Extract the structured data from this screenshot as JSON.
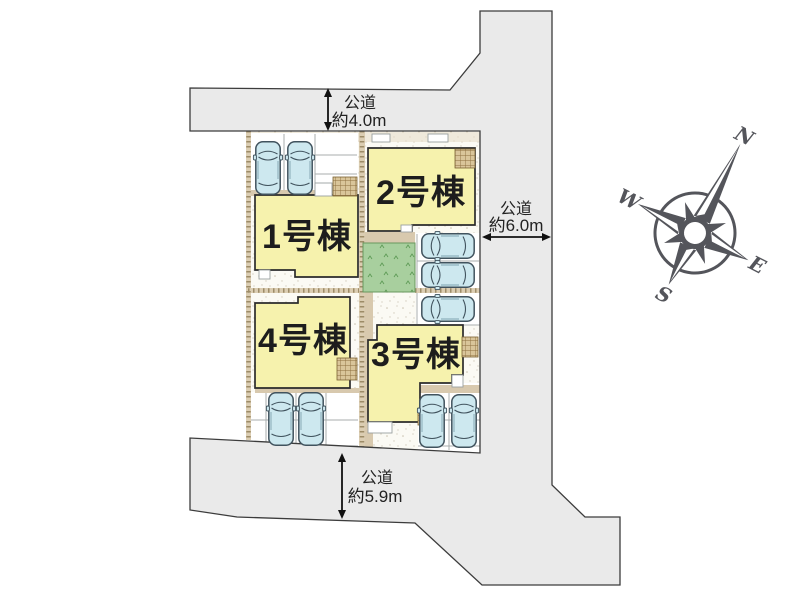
{
  "site_plan": {
    "buildings": [
      {
        "label": "1号棟"
      },
      {
        "label": "2号棟"
      },
      {
        "label": "3号棟"
      },
      {
        "label": "4号棟"
      }
    ],
    "roads": {
      "top": {
        "type_label": "公道",
        "width_label": "約4.0m"
      },
      "right": {
        "type_label": "公道",
        "width_label": "約6.0m"
      },
      "bottom": {
        "type_label": "公道",
        "width_label": "約5.9m"
      }
    },
    "compass": {
      "north": "N",
      "east": "E",
      "south": "S",
      "west": "W"
    }
  },
  "colors": {
    "background": "#ffffff",
    "road": "#eaeaea",
    "road_outline": "#3c3c3c",
    "building": "#f6f2ad",
    "building_outline": "#2b2b2b",
    "car": "#cde8ef",
    "car_outline": "#41535e",
    "garden": "#a8cf9e",
    "path_tan": "#d8c9ae",
    "porch_tan": "#d9c59a",
    "compass": "#54555b",
    "label_text": "#1d1d1d"
  }
}
